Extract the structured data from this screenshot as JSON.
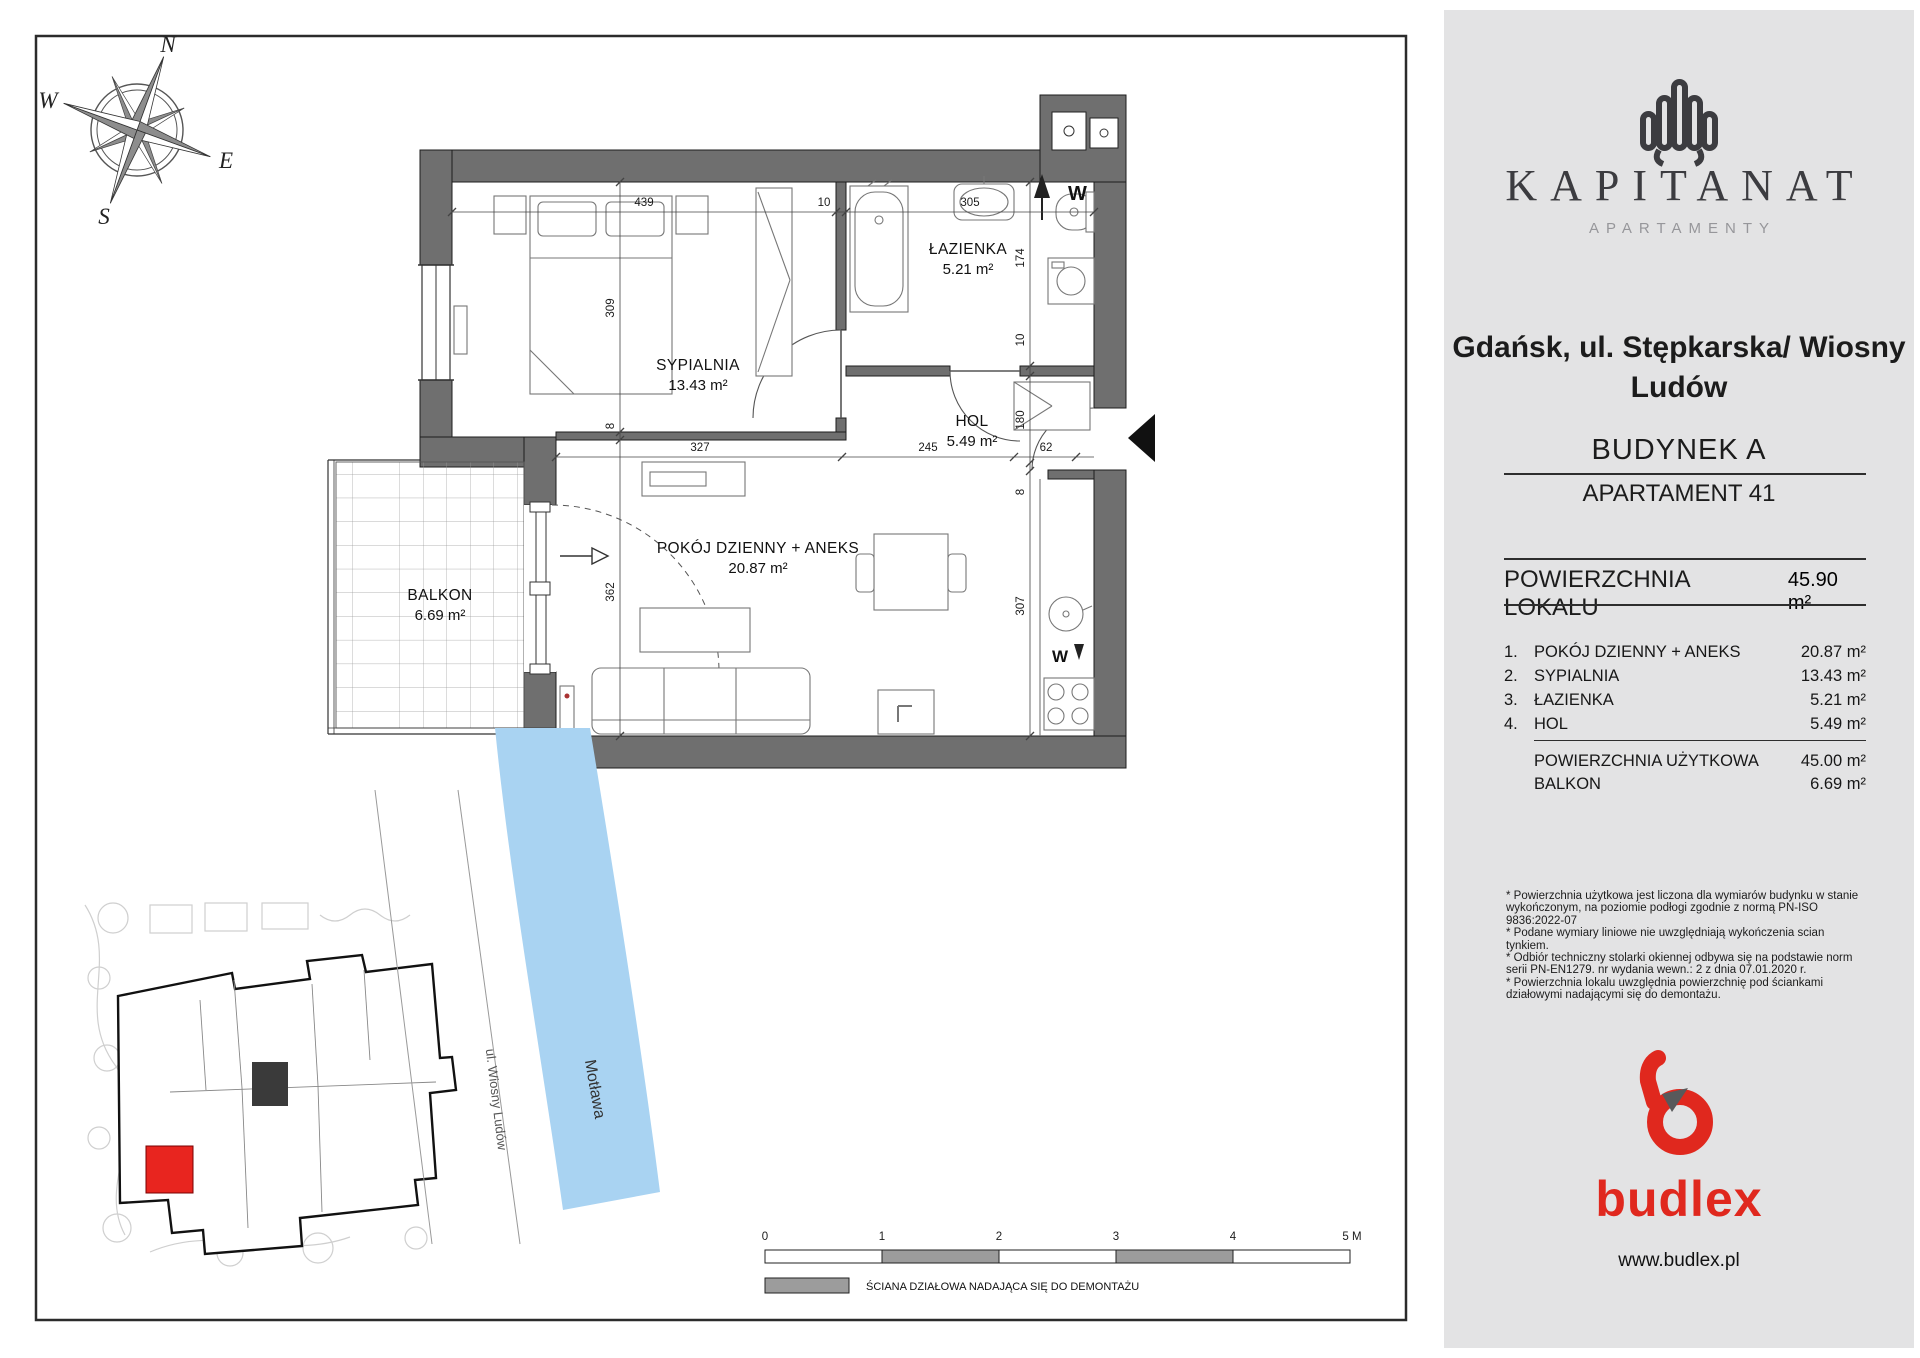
{
  "plan": {
    "compass": {
      "n": "N",
      "e": "E",
      "s": "S",
      "w": "W"
    },
    "rooms": [
      {
        "name": "SYPIALNIA",
        "area": "13.43 m²"
      },
      {
        "name": "ŁAZIENKA",
        "area": "5.21 m²"
      },
      {
        "name": "HOL",
        "area": "5.49 m²"
      },
      {
        "name": "POKÓJ DZIENNY + ANEKS",
        "area": "20.87 m²"
      },
      {
        "name": "BALKON",
        "area": "6.69 m²"
      }
    ],
    "dims": {
      "top_bedroom": "439",
      "top_wall": "10",
      "top_bath": "305",
      "right_bath": "174",
      "right_wall": "10",
      "right_hol": "180",
      "right_wall2": "8",
      "right_living": "307",
      "left_bedroom": "309",
      "left_wall": "8",
      "left_living": "362",
      "mid_living": "327",
      "mid_hol": "245",
      "mid_door": "62"
    },
    "markers": {
      "vent": "W",
      "washer": "W"
    }
  },
  "siteplan": {
    "river_label": "Motława",
    "street_label": "ul. Wiosny Ludów"
  },
  "scalebar": {
    "ticks": [
      "0",
      "1",
      "2",
      "3",
      "4",
      "5 M"
    ]
  },
  "legend_text": "ŚCIANA DZIAŁOWA NADAJĄCA SIĘ DO DEMONTAŻU",
  "sidebar": {
    "brand": "KAPITANAT",
    "brand_sub": "APARTAMENTY",
    "address_line1": "Gdańsk, ul. Stępkarska/ Wiosny",
    "address_line2": "Ludów",
    "building": "BUDYNEK A",
    "apartment": "APARTAMENT 41",
    "area_label": "POWIERZCHNIA LOKALU",
    "area_value": "45.90 m²",
    "rooms": [
      {
        "no": "1.",
        "name": "POKÓJ DZIENNY + ANEKS",
        "area": "20.87 m²"
      },
      {
        "no": "2.",
        "name": "SYPIALNIA",
        "area": "13.43 m²"
      },
      {
        "no": "3.",
        "name": "ŁAZIENKA",
        "area": "5.21 m²"
      },
      {
        "no": "4.",
        "name": "HOL",
        "area": "5.49 m²"
      }
    ],
    "usable_label": "POWIERZCHNIA UŻYTKOWA",
    "usable_value": "45.00 m²",
    "balcony_label": "BALKON",
    "balcony_value": "6.69 m²",
    "notes": [
      "* Powierzchnia użytkowa jest liczona dla wymiarów budynku w stanie wykończonym, na poziomie podłogi zgodnie z normą PN-ISO 9836:2022-07",
      "* Podane wymiary liniowe nie uwzględniają wykończenia scian tynkiem.",
      "* Odbiór techniczny stolarki okiennej odbywa się na podstawie norm serii PN-EN1279. nr wydania wewn.: 2 z dnia 07.01.2020 r.",
      "* Powierzchnia lokalu uwzględnia powierzchnię pod ściankami działowymi nadającymi się do demontażu."
    ],
    "logo_word": "budlex",
    "website": "www.budlex.pl",
    "accent": "#e0281e"
  }
}
